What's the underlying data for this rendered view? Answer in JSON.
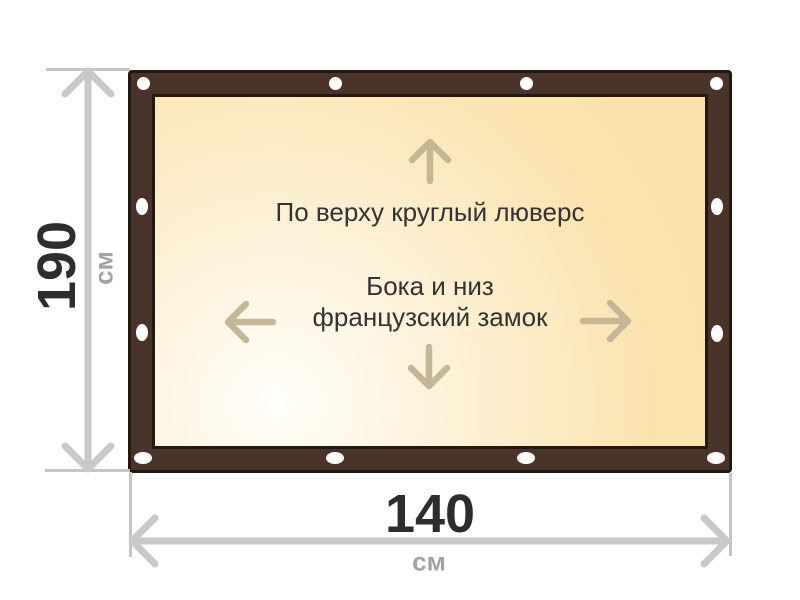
{
  "annotations": {
    "top_edge": "По верху круглый люверс",
    "sides_bottom_line1": "Бока и низ",
    "sides_bottom_line2": "французский замок"
  },
  "dimensions": {
    "height": {
      "value": "190",
      "unit": "см"
    },
    "width": {
      "value": "140",
      "unit": "см"
    }
  },
  "icons": {
    "up": "arrow-up-icon",
    "down": "arrow-down-icon",
    "left": "arrow-left-icon",
    "right": "arrow-right-icon",
    "grommet": "grommet-hole-icon"
  },
  "grommet_counts": {
    "top": 4,
    "bottom": 4,
    "left_side": 2,
    "right_side": 2
  },
  "colors": {
    "frame_brown": "#4a3429",
    "frame_outline": "#211912",
    "fabric_beige": "#fbe3ae",
    "fabric_highlight": "#fffef9",
    "direction_arrow": "#c4b795",
    "dimension_line": "#c9c9c9",
    "dimension_tick": "#c5c5c5",
    "dimension_value_text": "#2d2d2d",
    "dimension_unit_text": "#a3a3a3",
    "annotation_text": "#333333",
    "grommet_white": "#ffffff"
  }
}
